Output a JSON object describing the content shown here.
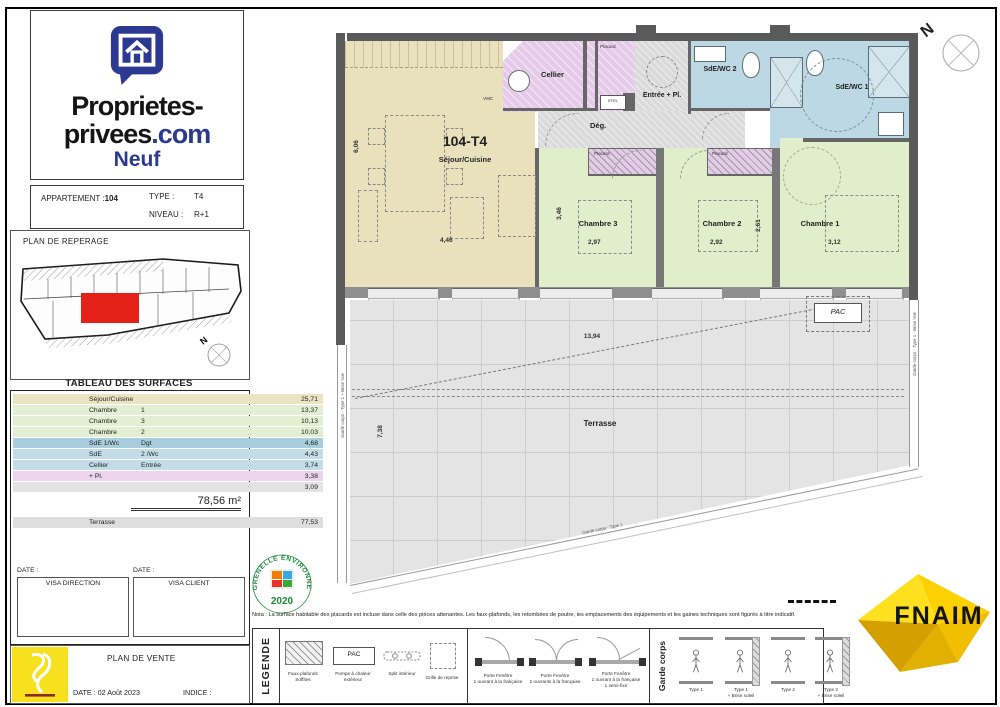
{
  "theme": {
    "accent_blue": "#2b3990",
    "highlight_red": "#e32119",
    "room_sejour": "#e8e1bc",
    "room_chambre": "#e0eecb",
    "room_wet": "#bcd8e4",
    "room_closet": "#e5cbe9",
    "room_corridor": "#dadada",
    "terrace_gray": "#e4e4e4",
    "wall_gray": "#5a5a5a",
    "fnaim_yellow": "#ffd500",
    "stamp_green": "#1f8a3d",
    "vente_yellow": "#f7e11e"
  },
  "branding": {
    "line1": "Proprietes-",
    "line2_main": "privees",
    "line2_accent": ".com",
    "line3": "Neuf"
  },
  "apartment_info": {
    "apt_label": "APPARTEMENT :",
    "apt_value": "104",
    "type_label": "TYPE :",
    "type_value": "T4",
    "niveau_label": "NIVEAU :",
    "niveau_value": "R+1"
  },
  "reperage": {
    "title": "PLAN DE REPERAGE",
    "north": "N"
  },
  "surfaces": {
    "title": "TABLEAU DES SURFACES",
    "rows": [
      {
        "label": "Séjour/Cuisine",
        "num": "",
        "value": "25,71",
        "color": "#ebe3c2"
      },
      {
        "label": "Chambre",
        "num": "1",
        "value": "13,37",
        "color": "#e3efd2"
      },
      {
        "label": "Chambre",
        "num": "3",
        "value": "10,13",
        "color": "#e3efd2"
      },
      {
        "label": "Chambre",
        "num": "2",
        "value": "10,03",
        "color": "#e3efd2"
      },
      {
        "label": "SdE 1/Wc",
        "num": "Dgt",
        "value": "4,68",
        "color": "#a8cede"
      },
      {
        "label": "SdE",
        "num": "2 /Wc",
        "value": "4,43",
        "color": "#c3dde8"
      },
      {
        "label": "Cellier",
        "num": "Entrée",
        "value": "3,74",
        "color": "#c3dde8"
      },
      {
        "label": "+ Pl.",
        "num": "",
        "value": "3,38",
        "color": "#ecd4ed"
      },
      {
        "label": "",
        "num": "",
        "value": "3,09",
        "color": "#e3e3e3"
      }
    ],
    "total": "78,56 m²",
    "terrasse_label": "Terrasse",
    "terrasse_value": "77,53",
    "terrasse_color": "#dedede"
  },
  "visa": {
    "date_label": "DATE :",
    "direction": "VISA DIRECTION",
    "client": "VISA CLIENT"
  },
  "vente": {
    "title": "PLAN DE VENTE",
    "date": "DATE : 02 Août 2023",
    "indice": "INDICE :"
  },
  "plan": {
    "unit": "104-T4",
    "sejour": "Séjour/Cuisine",
    "cellier": "Cellier",
    "entree": "Entrée + Pl.",
    "deg": "Dég.",
    "sde2": "SdE/WC 2",
    "sde1": "SdE/WC 1",
    "ch3": "Chambre 3",
    "ch2": "Chambre 2",
    "ch1": "Chambre 1",
    "terrasse": "Terrasse",
    "pac": "PAC",
    "placard": "Placard",
    "etel": "ETEL",
    "vmc": "VMC",
    "dims": {
      "sejour_h": "6,06",
      "sejour_w": "4,46",
      "ch3_h": "3,46",
      "ch3_w": "2,97",
      "ch2_w": "2,92",
      "ch2_h": "2,61",
      "ch1_w": "3,12",
      "terrasse_w": "13,94",
      "terrasse_h": "7,38"
    },
    "rails": {
      "left": "Garde corps - Type 1 + Brise Vue",
      "right": "Garde corps - Type 1 - Brise Vue",
      "bottom": "Garde corps - Type 1"
    }
  },
  "compass": {
    "label": "N"
  },
  "stamp": {
    "arc": "GRENELLE ENVIRONNEMENT",
    "year": "2020"
  },
  "nota": "Nota : La surface habitable des placards est incluse dans celle des pièces attenantes. Les faux-plafonds, les retombées de poutre, les emplacements des équipements et les gaines techniques sont figurés à titre indicatif.",
  "legend": {
    "title": "LEGENDE",
    "faux1": "Faux-plafonds",
    "faux2": "Soffites",
    "pac_box": "PAC",
    "pac1": "Pompe à chaleur",
    "pac2": "extérieur",
    "split": "Split intérieur",
    "grille": "Grille de reprise",
    "pf1a": "Porte Fenêtre",
    "pf1b": "1 ouvrant à la française",
    "pf2a": "Porte Fenêtre",
    "pf2b": "2 ouvrants à la française",
    "pf3a": "Porte Fenêtre",
    "pf3b": "1 ouvrant à la française",
    "pf3c": "1 semi-fixe",
    "gc_title": "Garde corps",
    "gc1": "Type 1",
    "gc2a": "Type 1",
    "gc2b": "+ Brise soleil",
    "gc3": "Type 2",
    "gc4a": "Type 2",
    "gc4b": "+ Brise soleil"
  },
  "fnaim": {
    "text": "FNAIM"
  }
}
